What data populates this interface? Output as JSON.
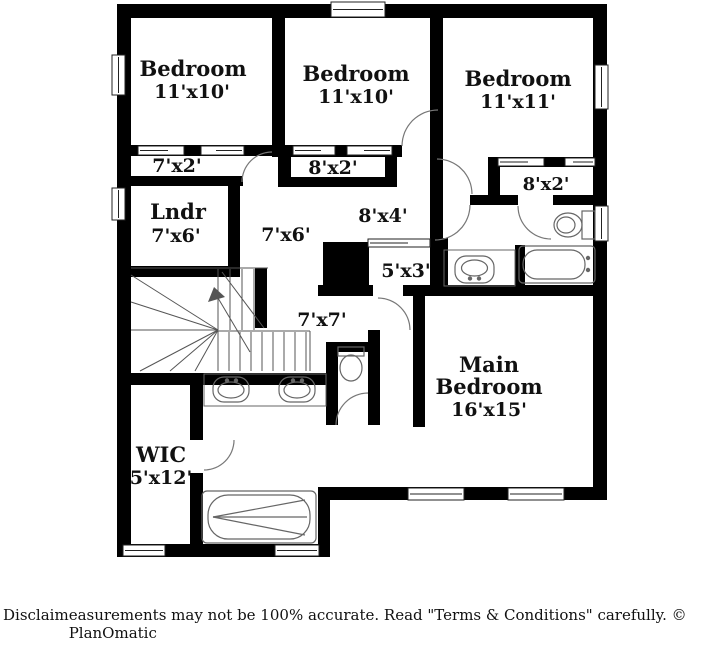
{
  "page": {
    "background": "#ffffff"
  },
  "plan": {
    "wall_color": "#000000",
    "line_color": "#666666",
    "text_color": "#111111",
    "fixture_names": [
      "staircase",
      "double-vanity-sink",
      "toilet",
      "garden-tub",
      "bathtub",
      "vanity-sink",
      "window",
      "closet-sliding-door",
      "chase"
    ],
    "labels": [
      {
        "text": "Bedroom",
        "x": 193,
        "y": 76,
        "size": 21
      },
      {
        "text": "11'x10'",
        "x": 192,
        "y": 98,
        "size": 19
      },
      {
        "text": "Bedroom",
        "x": 356,
        "y": 81,
        "size": 21
      },
      {
        "text": "11'x10'",
        "x": 356,
        "y": 103,
        "size": 19
      },
      {
        "text": "Bedroom",
        "x": 518,
        "y": 86,
        "size": 21
      },
      {
        "text": "11'x11'",
        "x": 518,
        "y": 108,
        "size": 19
      },
      {
        "text": "7'x2'",
        "x": 177,
        "y": 172,
        "size": 19
      },
      {
        "text": "8'x2'",
        "x": 333,
        "y": 174,
        "size": 19
      },
      {
        "text": "8'x2'",
        "x": 546,
        "y": 190,
        "size": 18
      },
      {
        "text": "Lndr",
        "x": 178,
        "y": 219,
        "size": 21
      },
      {
        "text": "7'x6'",
        "x": 176,
        "y": 242,
        "size": 19
      },
      {
        "text": "7'x6'",
        "x": 286,
        "y": 241,
        "size": 19
      },
      {
        "text": "8'x4'",
        "x": 383,
        "y": 222,
        "size": 19
      },
      {
        "text": "5'x3'",
        "x": 406,
        "y": 277,
        "size": 19
      },
      {
        "text": "7'x7'",
        "x": 322,
        "y": 326,
        "size": 19
      },
      {
        "text": "Main",
        "x": 489,
        "y": 372,
        "size": 21
      },
      {
        "text": "Bedroom",
        "x": 489,
        "y": 394,
        "size": 21
      },
      {
        "text": "16'x15'",
        "x": 489,
        "y": 416,
        "size": 19
      },
      {
        "text": "WIC",
        "x": 161,
        "y": 462,
        "size": 21
      },
      {
        "text": "5'x12'",
        "x": 161,
        "y": 484,
        "size": 19
      }
    ]
  },
  "footer": {
    "left": "Disclaim",
    "text": "easurements may not be 100% accurate. Read \"Terms & Conditions\" carefully. © PlanOmatic"
  }
}
